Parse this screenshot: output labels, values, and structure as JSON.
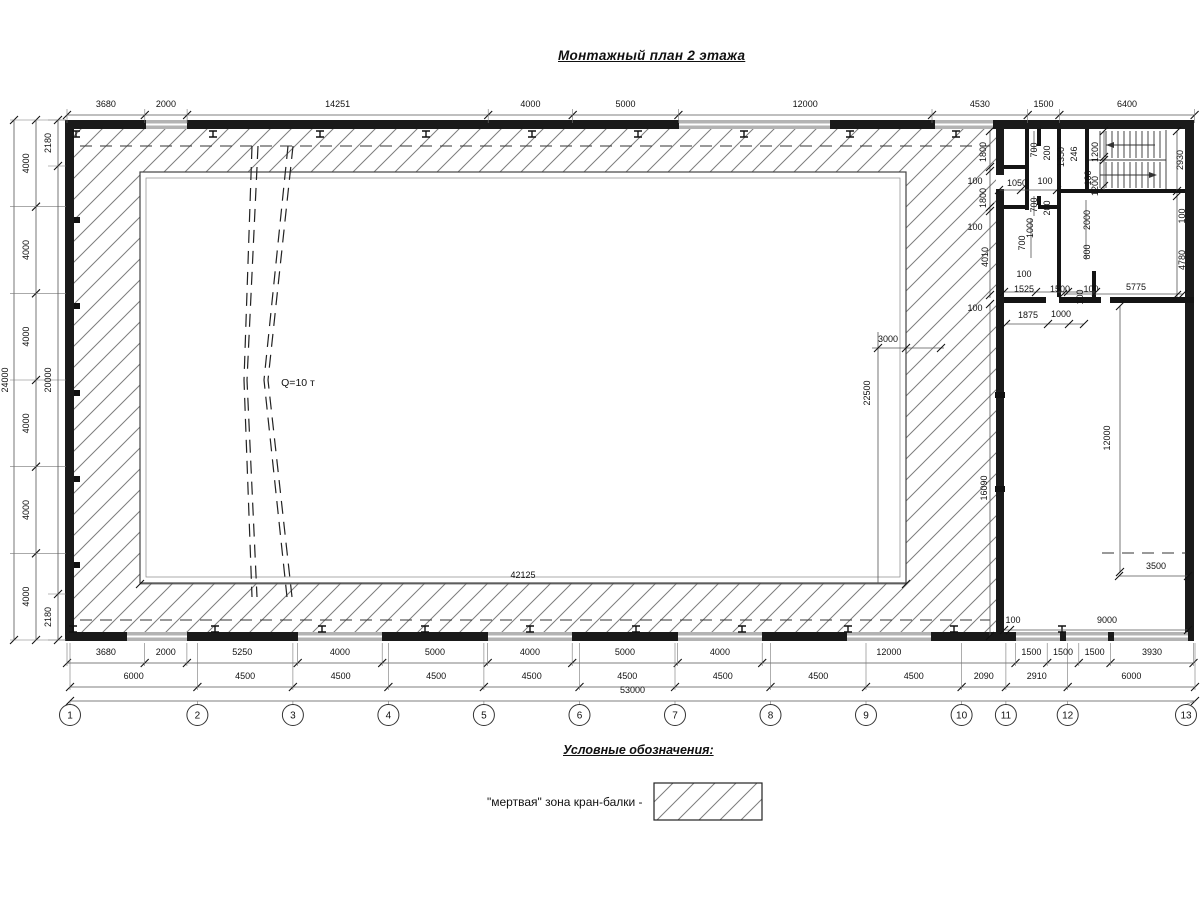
{
  "title": "Монтажный план 2 этажа",
  "legend": {
    "heading": "Условные обозначения:",
    "item_label": "\"мертвая\" зона кран-балки -"
  },
  "drawing": {
    "crane_capacity_label": "Q=10 т",
    "dim_rows": [
      {
        "name": "top",
        "y": 115,
        "yText": 107,
        "ext": [
          109,
          123
        ],
        "ticks": [
          67,
          144.8,
          187.1,
          488.2,
          572.7,
          678.4,
          932,
          1027.7,
          1059.4,
          1194.6
        ],
        "labels": [
          "3680",
          "2000",
          "14251",
          "4000",
          "5000",
          "12000",
          "4530",
          "1500",
          "6400"
        ]
      },
      {
        "name": "bottom-spans",
        "y": 663,
        "yText": 655,
        "ext": [
          643,
          666
        ],
        "ticks": [
          67,
          144.7,
          186.9,
          297.7,
          382.2,
          487.7,
          572.2,
          677.7,
          762.2,
          1015.5,
          1047.2,
          1078.8,
          1110.5,
          1193.5
        ],
        "labels": [
          "3680",
          "2000",
          "5250",
          "4000",
          "5000",
          "4000",
          "5000",
          "4000",
          "12000",
          "1500",
          "1500",
          "1500",
          "3930"
        ]
      },
      {
        "name": "bottom-axes",
        "y": 687,
        "yText": 679,
        "ext": [
          643,
          690
        ],
        "ticks": [
          70,
          197.4,
          292.9,
          388.4,
          483.9,
          579.5,
          675,
          770.5,
          866,
          961.6,
          1005.9,
          1067.7,
          1195
        ],
        "labels": [
          "6000",
          "4500",
          "4500",
          "4500",
          "4500",
          "4500",
          "4500",
          "4500",
          "4500",
          "2090",
          "2910",
          "6000"
        ]
      },
      {
        "name": "bottom-total",
        "y": 701,
        "yText": 693,
        "ticks": [
          70,
          1195
        ],
        "labels": [
          "53000"
        ]
      }
    ],
    "dim_cols": [
      {
        "name": "left-total",
        "x": 14,
        "xText": 8,
        "ticks": [
          120,
          640
        ],
        "labels": [
          "24000"
        ]
      },
      {
        "name": "left-4000",
        "x": 36,
        "xText": 29,
        "ext": [
          10,
          66
        ],
        "ticks": [
          120,
          206.7,
          293.3,
          380,
          466.7,
          553.3,
          640
        ],
        "labels": [
          "4000",
          "4000",
          "4000",
          "4000",
          "4000",
          "4000"
        ]
      },
      {
        "name": "left-inner",
        "x": 58,
        "xText": 51,
        "ext": [
          48,
          66
        ],
        "ticks": [
          120,
          166,
          594,
          640
        ],
        "labels": [
          "2180",
          "20000",
          "2180"
        ]
      }
    ],
    "axes": {
      "labels": [
        "1",
        "2",
        "3",
        "4",
        "5",
        "6",
        "7",
        "8",
        "9",
        "10",
        "11",
        "12",
        "13"
      ],
      "tx": [
        70,
        197.4,
        292.9,
        388.4,
        483.9,
        579.5,
        675,
        770.5,
        866,
        961.6,
        1005.9,
        1067.7,
        1195
      ],
      "bx": [
        70,
        197.4,
        292.9,
        388.4,
        483.9,
        579.5,
        675,
        770.5,
        866,
        961.6,
        1005.9,
        1067.7,
        1186
      ],
      "y": 715,
      "r": 10.5
    },
    "free_labels": [
      {
        "t": "Q=10 т",
        "x": 298,
        "y": 386,
        "r": 0,
        "big": 1
      },
      {
        "t": "42125",
        "x": 523,
        "y": 578,
        "r": 0
      },
      {
        "t": "3000",
        "x": 888,
        "y": 342,
        "r": 0
      },
      {
        "t": "22500",
        "x": 870,
        "y": 393,
        "r": 1
      },
      {
        "t": "1800",
        "x": 986,
        "y": 152,
        "r": 1
      },
      {
        "t": "100",
        "x": 975,
        "y": 184,
        "r": 0
      },
      {
        "t": "1800",
        "x": 986,
        "y": 198,
        "r": 1
      },
      {
        "t": "100",
        "x": 975,
        "y": 230,
        "r": 0
      },
      {
        "t": "4010",
        "x": 988,
        "y": 257,
        "r": 1
      },
      {
        "t": "100",
        "x": 975,
        "y": 311,
        "r": 0
      },
      {
        "t": "16090",
        "x": 987,
        "y": 488,
        "r": 1
      },
      {
        "t": "1050",
        "x": 1017,
        "y": 186,
        "r": 0
      },
      {
        "t": "100",
        "x": 1045,
        "y": 184,
        "r": 0
      },
      {
        "t": "700",
        "x": 1037,
        "y": 150,
        "r": 1
      },
      {
        "t": "200",
        "x": 1050,
        "y": 153,
        "r": 1
      },
      {
        "t": "1350",
        "x": 1064,
        "y": 157,
        "r": 1
      },
      {
        "t": "246",
        "x": 1077,
        "y": 154,
        "r": 1
      },
      {
        "t": "700",
        "x": 1037,
        "y": 205,
        "r": 1
      },
      {
        "t": "200",
        "x": 1050,
        "y": 208,
        "r": 1
      },
      {
        "t": "1000",
        "x": 1033,
        "y": 228,
        "r": 1
      },
      {
        "t": "700",
        "x": 1025,
        "y": 243,
        "r": 1
      },
      {
        "t": "2000",
        "x": 1090,
        "y": 220,
        "r": 1
      },
      {
        "t": "800",
        "x": 1090,
        "y": 252,
        "r": 1
      },
      {
        "t": "1200",
        "x": 1098,
        "y": 152,
        "r": 1
      },
      {
        "t": "100",
        "x": 1091,
        "y": 178,
        "r": 1
      },
      {
        "t": "1200",
        "x": 1098,
        "y": 186,
        "r": 1
      },
      {
        "t": "2930",
        "x": 1183,
        "y": 160,
        "r": 1
      },
      {
        "t": "100",
        "x": 1185,
        "y": 216,
        "r": 1
      },
      {
        "t": "4780",
        "x": 1185,
        "y": 260,
        "r": 1
      },
      {
        "t": "100",
        "x": 1024,
        "y": 277,
        "r": 0
      },
      {
        "t": "1525",
        "x": 1024,
        "y": 292,
        "r": 0
      },
      {
        "t": "1500",
        "x": 1060,
        "y": 292,
        "r": 0
      },
      {
        "t": "100",
        "x": 1091,
        "y": 292,
        "r": 0
      },
      {
        "t": "100",
        "x": 1083,
        "y": 297,
        "r": 1
      },
      {
        "t": "5775",
        "x": 1136,
        "y": 290,
        "r": 0
      },
      {
        "t": "1875",
        "x": 1028,
        "y": 318,
        "r": 0
      },
      {
        "t": "1000",
        "x": 1061,
        "y": 317,
        "r": 0
      },
      {
        "t": "12000",
        "x": 1110,
        "y": 438,
        "r": 1
      },
      {
        "t": "3500",
        "x": 1156,
        "y": 569,
        "r": 0
      },
      {
        "t": "100",
        "x": 1013,
        "y": 623,
        "r": 0
      },
      {
        "t": "9000",
        "x": 1107,
        "y": 623,
        "r": 0
      }
    ]
  }
}
